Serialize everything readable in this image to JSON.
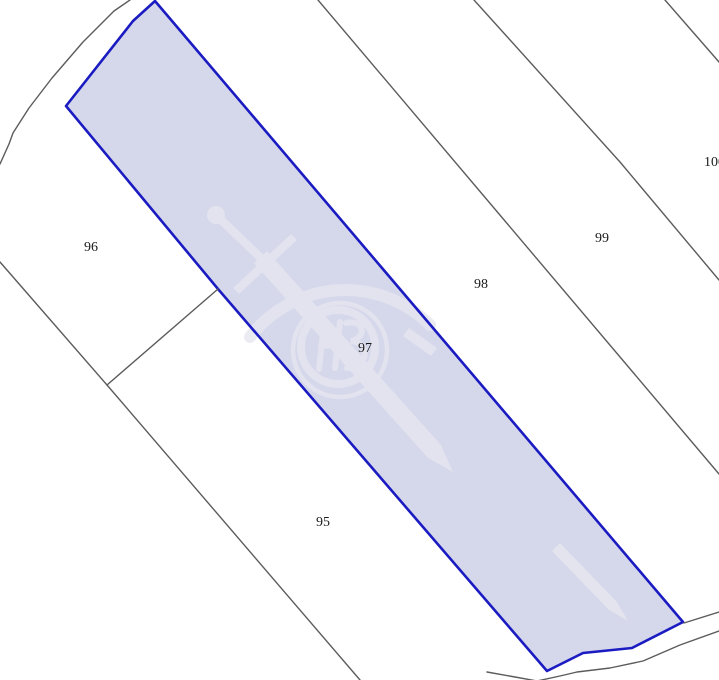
{
  "map": {
    "background_color": "#ffffff",
    "boundary_line_color": "#5c5c5c",
    "label_color": "#1a1a1a",
    "highlighted_parcel": {
      "label": "97",
      "fill": "#d5d7eb",
      "border_color": "#1b1bc2"
    },
    "watermark": {
      "name": "sword-and-ring-emblem",
      "color": "#e7e7f0",
      "opacity": "0.8"
    },
    "parcels": [
      {
        "label": "95",
        "highlighted": false
      },
      {
        "label": "96",
        "highlighted": false
      },
      {
        "label": "97",
        "highlighted": true
      },
      {
        "label": "98",
        "highlighted": false
      },
      {
        "label": "99",
        "highlighted": false
      },
      {
        "label": "100",
        "highlighted": false
      }
    ]
  }
}
